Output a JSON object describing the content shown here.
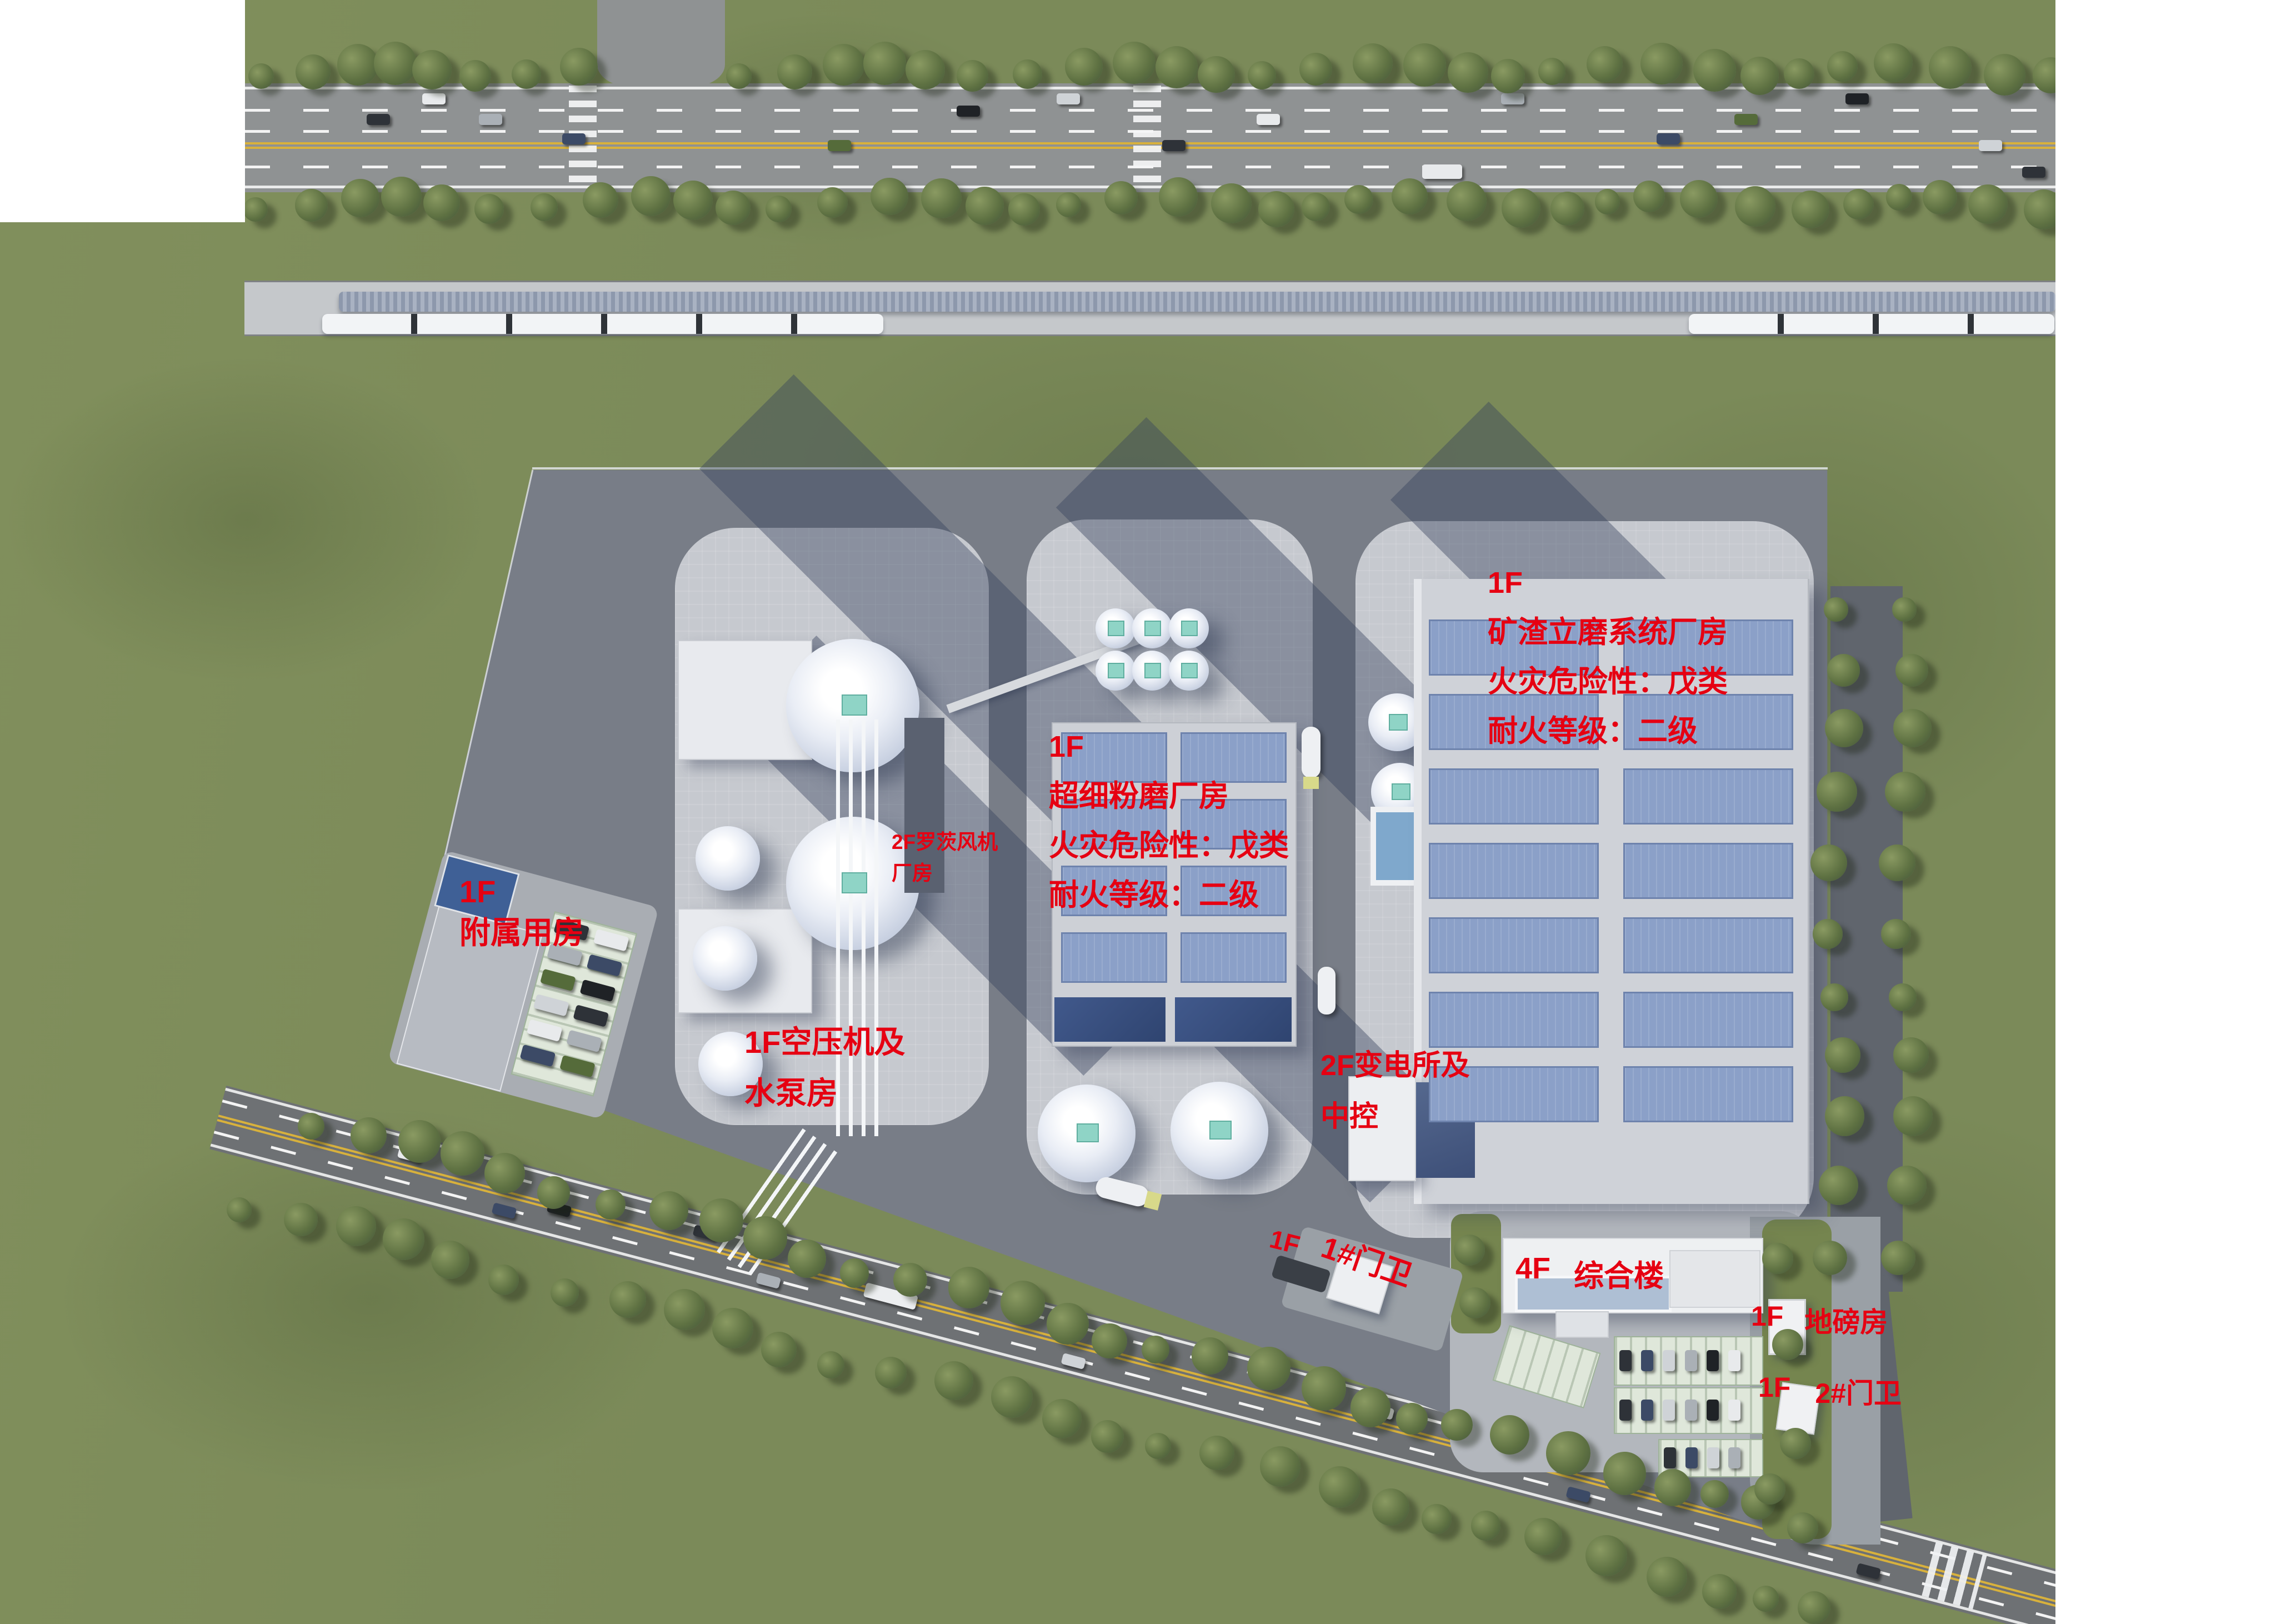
{
  "title": "优化后方案",
  "colors": {
    "label_red": "#e60012",
    "title_black": "#000000",
    "grass_green": "#7b8a59",
    "asphalt_gray": "#8f9293",
    "site_pavement_gray": "#787d87",
    "pad_light_gray": "#c6c9cf",
    "roof_gray": "#cfd2d8",
    "skylight_blue": "#8ba0c8",
    "dome_white": "#f4f6fa",
    "equipment_teal": "#8fd4c6",
    "rail_bed_gray": "#c5c8cb",
    "train_white": "#f2f4f6",
    "lane_yellow": "#d8b13c"
  },
  "labels": {
    "slag_mill": {
      "floor": "1F",
      "name": "矿渣立磨系统厂房",
      "fire_hazard": "火灾危险性：戊类",
      "fire_rating": "耐火等级：二级"
    },
    "ultrafine_mill": {
      "floor": "1F",
      "name": "超细粉磨厂房",
      "fire_hazard": "火灾危险性：戊类",
      "fire_rating": "耐火等级：二级"
    },
    "roots_blower": {
      "line1": "2F罗茨风机",
      "line2": "厂房"
    },
    "auxiliary": {
      "floor": "1F",
      "name": "附属用房"
    },
    "air_compressor": {
      "line1": "1F空压机及",
      "line2": "水泵房"
    },
    "substation": {
      "line1": "2F变电所及",
      "line2": "中控"
    },
    "gate1": {
      "floor": "1F",
      "name": "1#门卫"
    },
    "office": {
      "floor": "4F",
      "name": "综合楼"
    },
    "weighbridge": {
      "floor": "1F",
      "name": "地磅房"
    },
    "gate2": {
      "floor": "1F",
      "name": "2#门卫"
    }
  }
}
